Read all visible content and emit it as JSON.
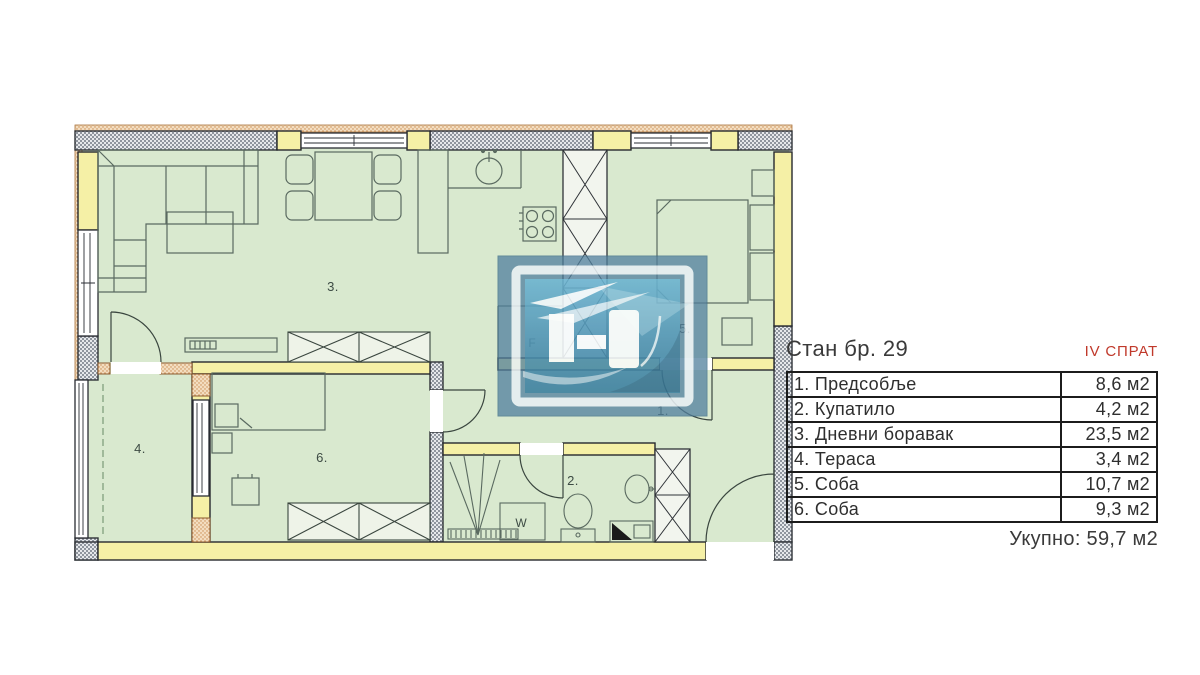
{
  "header": {
    "title": "Стан бр. 29",
    "floor": "IV СПРАТ"
  },
  "table": {
    "rows": [
      {
        "name": "1. Предсобље",
        "area": "8,6 м2"
      },
      {
        "name": "2. Купатило",
        "area": "4,2 м2"
      },
      {
        "name": "3. Дневни боравак",
        "area": "23,5 м2"
      },
      {
        "name": "4. Тераса",
        "area": "3,4 м2"
      },
      {
        "name": "5. Соба",
        "area": "10,7 м2"
      },
      {
        "name": "6. Соба",
        "area": "9,3 м2"
      }
    ],
    "total": "Укупно: 59,7 м2"
  },
  "plan": {
    "labels": {
      "hallway": "1.",
      "bathroom": "2.",
      "living": "3.",
      "terrace": "4.",
      "bedroom5": "5.",
      "bedroom6": "6.",
      "fridge": "F",
      "washer": "W"
    }
  },
  "colors": {
    "accent_red": "#c0392b",
    "wall_yellow": "#f5f0a6",
    "floor_green": "#d9e9cf",
    "wall_gray": "#9aa1ab",
    "insulation_orange": "#e9c9a2",
    "logo_blue": "#4f81a0"
  }
}
